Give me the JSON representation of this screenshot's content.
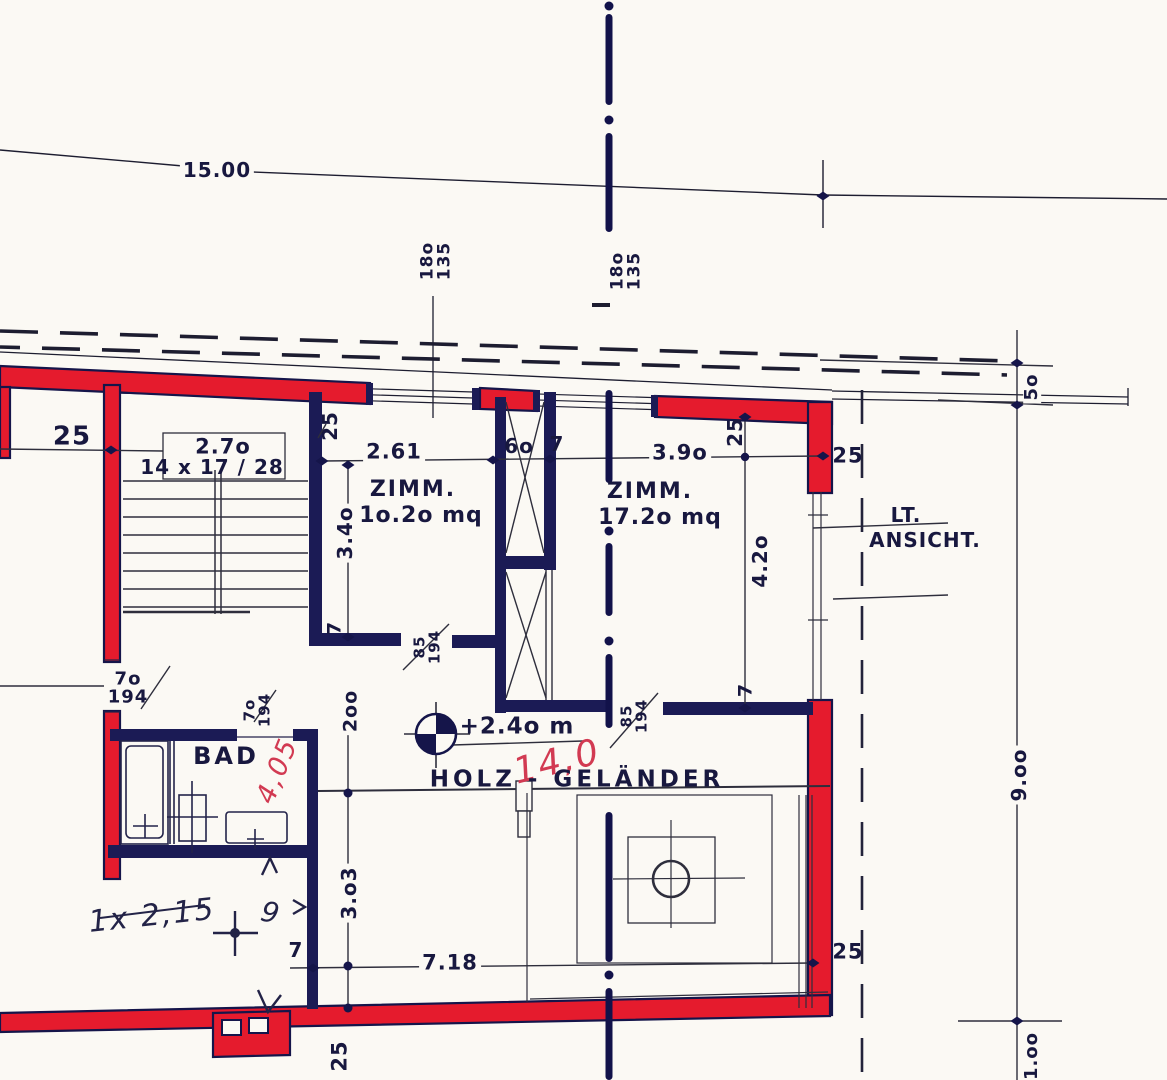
{
  "drawing": {
    "type": "floor-plan",
    "colors": {
      "wall_red": "#e51b2d",
      "wall_navy": "#1b1b55",
      "ink": "#18183f",
      "hand_red": "#d23a52",
      "paper": "#fbf9f4"
    }
  },
  "labels": {
    "dim_overall": "15.00",
    "window_top_left": "18o\n135",
    "window_top_center": "18o\n135",
    "dim_25_wall_left": "25",
    "stair_width": "2.7o",
    "stair_steps": "14 x 17 / 28",
    "dim_25_stair_wall": "25",
    "dim_left_room_width": "2.61",
    "dim_flue_width": "6o",
    "dim_flue_wall": "7",
    "dim_right_room_width": "3.9o",
    "dim_25_corner_v": "25",
    "dim_25_corner_h": "25",
    "room_left_name": "ZIMM.",
    "room_left_area": "1o.2o mq",
    "room_right_name": "ZIMM.",
    "room_right_area": "17.2o mq",
    "dim_left_room_depth": "3.4o",
    "dim_7_left_room": "7",
    "door_left_room": "85\n194",
    "door_right_room": "85\n194",
    "dim_right_room_depth": "4.2o",
    "dim_7_right_room": "7",
    "view_ref_line1": "LT.",
    "view_ref_line2": "ANSICHT.",
    "dim_50_eave": "5o",
    "door_hall": "7o\n194",
    "door_bad": "7o\n194",
    "dim_200_landing": "2oo",
    "room_bad": "BAD",
    "hand_red_405": "4,05",
    "level_mark": "+2.4o m",
    "hand_red_140": "14,0",
    "railing": "HOLZ - GELÄNDER",
    "dim_gallery_depth": "3.o3",
    "dim_7_gallery": "7",
    "dim_gallery_width": "7.18",
    "dim_25_gallery": "25",
    "dim_25_bottom": "25",
    "dim_9m": "9.oo",
    "dim_1m": "1.oo",
    "hand_note": "1x 2,15",
    "hand_squiggle": "9"
  }
}
